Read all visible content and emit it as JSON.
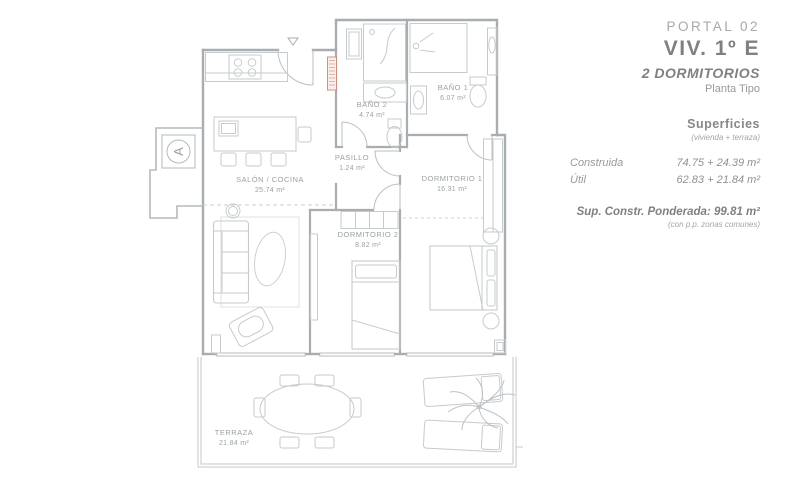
{
  "header": {
    "portal": "PORTAL 02",
    "unit": "VIV. 1º E",
    "type": "2 DORMITORIOS",
    "plan": "Planta Tipo"
  },
  "surfaces": {
    "title": "Superficies",
    "subtitle": "(vivienda + terraza)",
    "rows": [
      {
        "label": "Construida",
        "value": "74.75 + 24.39 m²"
      },
      {
        "label": "Útil",
        "value": "62.83 + 21.84 m²"
      }
    ],
    "weighted": "Sup. Constr. Ponderada: 99.81 m²",
    "weighted_note": "(con p.p. zonas comunes)"
  },
  "rooms": {
    "salon": {
      "name": "SALÓN / COCINA",
      "area": "25.74 m²"
    },
    "pasillo": {
      "name": "PASILLO",
      "area": "1.24 m²"
    },
    "bano1": {
      "name": "BAÑO 1",
      "area": "6.07 m²"
    },
    "bano2": {
      "name": "BAÑO 2",
      "area": "4.74 m²"
    },
    "dormitorio1": {
      "name": "DORMITORIO 1",
      "area": "16.31 m²"
    },
    "dormitorio2": {
      "name": "DORMITORIO 2",
      "area": "8.82 m²"
    },
    "terraza": {
      "name": "TERRAZA",
      "area": "21.84 m²"
    }
  },
  "core": {
    "label": "A"
  },
  "colors": {
    "wall": "#a7adb0",
    "furniture": "#c6cbce",
    "label_text": "#9ba0a3",
    "shaft_red": "#c98779"
  }
}
